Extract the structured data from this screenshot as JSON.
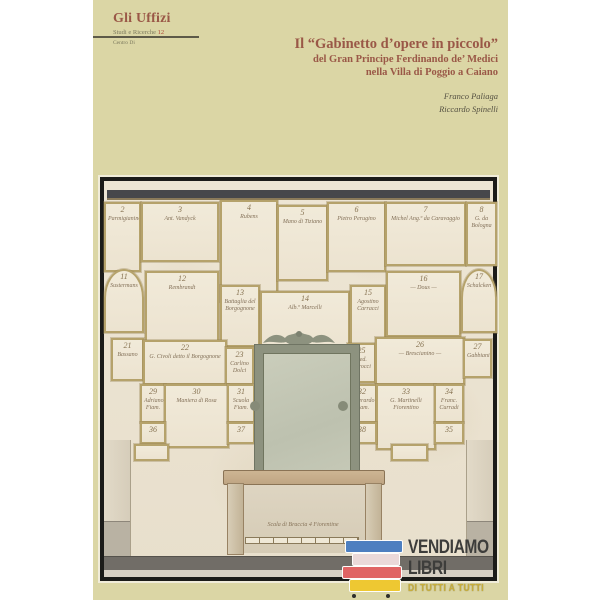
{
  "series": {
    "title": "Gli Uffizi",
    "subtitle": "Studi e Ricerche",
    "number": "12",
    "imprint": "Centro Di"
  },
  "title": {
    "line1": "Il “Gabinetto d’opere in piccolo”",
    "line2": "del Gran Principe Ferdinando de’ Medici",
    "line3": "nella Villa di Poggio a Caiano",
    "color": "#9a5847"
  },
  "authors": [
    "Franco Paliaga",
    "Riccardo Spinelli"
  ],
  "plate": {
    "caption": "Scala di Braccia 4 Fiorentine",
    "paper_color": "#ebe3d2",
    "frame_line_color": "#b5a26b",
    "ink_color": "#837058",
    "cornice_color": "#46474b",
    "mirror_glass_color": "#c4c8b6",
    "frames": [
      {
        "n": "2",
        "name": "Parmigianino",
        "x": 0,
        "y": 21,
        "w": 33,
        "h": 66
      },
      {
        "n": "3",
        "name": "Ant. Vandyck",
        "x": 37,
        "y": 21,
        "w": 74,
        "h": 56
      },
      {
        "n": "4",
        "name": "Rubens",
        "x": 116,
        "y": 19,
        "w": 54,
        "h": 98
      },
      {
        "n": "5",
        "name": "Mano di Tiziano",
        "x": 173,
        "y": 24,
        "w": 47,
        "h": 72
      },
      {
        "n": "6",
        "name": "Pietro Perugino",
        "x": 223,
        "y": 21,
        "w": 55,
        "h": 66
      },
      {
        "n": "7",
        "name": "Michel Ang.º da Caravaggio",
        "x": 281,
        "y": 21,
        "w": 77,
        "h": 60
      },
      {
        "n": "8",
        "name": "G. da Bologna",
        "x": 362,
        "y": 21,
        "w": 27,
        "h": 60
      },
      {
        "n": "11",
        "name": "Sustermans",
        "x": 0,
        "y": 88,
        "w": 36,
        "h": 60,
        "arch": true
      },
      {
        "n": "12",
        "name": "Rembrandt",
        "x": 41,
        "y": 90,
        "w": 70,
        "h": 68
      },
      {
        "n": "13",
        "name": "Battaglia del Borgognone",
        "x": 116,
        "y": 104,
        "w": 36,
        "h": 58
      },
      {
        "n": "14",
        "name": "Alb.º Marcelli",
        "x": 156,
        "y": 110,
        "w": 86,
        "h": 56
      },
      {
        "n": "15",
        "name": "Agostino Carracci",
        "x": 246,
        "y": 104,
        "w": 32,
        "h": 58
      },
      {
        "n": "16",
        "name": "— Dous —",
        "x": 282,
        "y": 90,
        "w": 71,
        "h": 62
      },
      {
        "n": "17",
        "name": "Schalcken",
        "x": 357,
        "y": 88,
        "w": 32,
        "h": 60,
        "arch": true
      },
      {
        "n": "21",
        "name": "Bassano",
        "x": 7,
        "y": 157,
        "w": 29,
        "h": 39
      },
      {
        "n": "22",
        "name": "G. Civoli detto il Borgognone",
        "x": 39,
        "y": 159,
        "w": 80,
        "h": 41
      },
      {
        "n": "23",
        "name": "Carlino Dolci",
        "x": 121,
        "y": 166,
        "w": 25,
        "h": 34
      },
      {
        "n": "25",
        "name": "Fed. Barocci",
        "x": 243,
        "y": 162,
        "w": 25,
        "h": 36
      },
      {
        "n": "26",
        "name": "— Brescianino —",
        "x": 271,
        "y": 156,
        "w": 86,
        "h": 44
      },
      {
        "n": "27",
        "name": "Gabbiani",
        "x": 359,
        "y": 158,
        "w": 25,
        "h": 35
      },
      {
        "n": "29",
        "name": "Adriano Fiam.",
        "x": 36,
        "y": 203,
        "w": 22,
        "h": 35
      },
      {
        "n": "30",
        "name": "Maniera di Rosa",
        "x": 60,
        "y": 203,
        "w": 61,
        "h": 60
      },
      {
        "n": "31",
        "name": "Scuola Fiam.",
        "x": 123,
        "y": 203,
        "w": 24,
        "h": 35
      },
      {
        "n": "32",
        "name": "Gherardo Fiam.",
        "x": 243,
        "y": 203,
        "w": 26,
        "h": 35
      },
      {
        "n": "33",
        "name": "G. Martinelli Fiorentino",
        "x": 272,
        "y": 203,
        "w": 56,
        "h": 62
      },
      {
        "n": "34",
        "name": "Franc. Curradi",
        "x": 330,
        "y": 203,
        "w": 26,
        "h": 35
      },
      {
        "n": "36",
        "name": "",
        "x": 36,
        "y": 241,
        "w": 22,
        "h": 18
      },
      {
        "n": "37",
        "name": "",
        "x": 123,
        "y": 241,
        "w": 24,
        "h": 18
      },
      {
        "n": "38",
        "name": "",
        "x": 243,
        "y": 241,
        "w": 26,
        "h": 18
      },
      {
        "n": "35",
        "name": "",
        "x": 330,
        "y": 241,
        "w": 26,
        "h": 18
      },
      {
        "n": "",
        "name": "",
        "x": 30,
        "y": 263,
        "w": 31,
        "h": 13
      },
      {
        "n": "",
        "name": "",
        "x": 287,
        "y": 263,
        "w": 33,
        "h": 13
      }
    ]
  },
  "logo": {
    "line1": "VENDIAMO",
    "line2": "LIBRI",
    "tagline": "DI TUTTI A TUTTI",
    "book_colors": [
      "#4d7fc0",
      "#ead9d9",
      "#e06464",
      "#eec832"
    ]
  }
}
